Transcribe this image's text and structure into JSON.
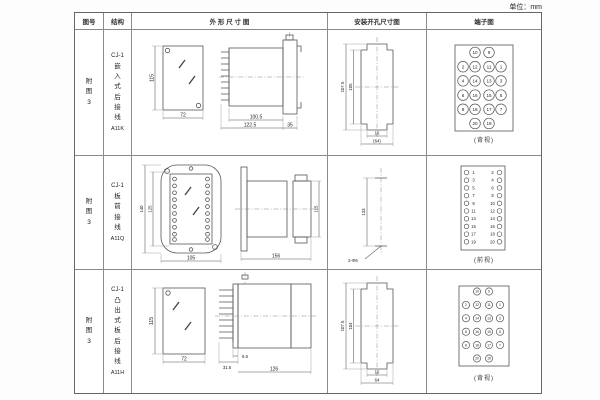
{
  "unit_label": "单位：mm",
  "headers": {
    "fig_no": "图号",
    "structure": "结构",
    "outline": "外 形 尺 寸 图",
    "install": "安装开孔尺寸图",
    "terminal": "端子图"
  },
  "rows": [
    {
      "fig_no": "附图3",
      "model": "CJ-1",
      "mount": "嵌入式后接线",
      "code": "A11K",
      "outline": {
        "front_h": "115",
        "front_w": "72",
        "body_d": "100.5",
        "total_d": "122.5",
        "flange_d": "35"
      },
      "install": {
        "outer_h": "107.5",
        "inner_h": "105",
        "slot_w": "16",
        "hole_w": "(64)"
      },
      "terminal": {
        "layout": "rear",
        "size": "lg",
        "caption": "(背视)",
        "side_left": [
          "2",
          "4",
          "6",
          "8"
        ],
        "mid_left": [
          "10",
          "12",
          "14",
          "16",
          "18",
          "20"
        ],
        "mid_right": [
          "9",
          "11",
          "13",
          "15",
          "17",
          "19"
        ],
        "side_right": [
          "1",
          "3",
          "5",
          "7"
        ]
      }
    },
    {
      "fig_no": "附图3",
      "model": "CJ-1",
      "mount": "板前接线",
      "code": "A11Q",
      "outline": {
        "front_outer_h": "140",
        "front_inner_h": "125",
        "front_w": "105",
        "total_d": "156",
        "body_h": "115"
      },
      "install": {
        "hole_pitch": "133",
        "hole_note": "2-Φ6"
      },
      "terminal": {
        "layout": "front",
        "caption": "(前视)",
        "pairs": [
          [
            "1",
            "2"
          ],
          [
            "3",
            "4"
          ],
          [
            "5",
            "6"
          ],
          [
            "7",
            "8"
          ],
          [
            "9",
            "10"
          ],
          [
            "11",
            "12"
          ],
          [
            "13",
            "14"
          ],
          [
            "15",
            "16"
          ],
          [
            "17",
            "18"
          ],
          [
            "19",
            "20"
          ]
        ]
      }
    },
    {
      "fig_no": "附图3",
      "model": "CJ-1",
      "mount": "凸出式板后接线",
      "code": "A11H",
      "outline": {
        "front_h": "115",
        "front_w": "72",
        "pin_d": "9.5",
        "base_d": "31.5",
        "body_d": "126"
      },
      "install": {
        "outer_h": "107.5",
        "inner_h": "104",
        "slot_w": "16",
        "hole_w": "64"
      },
      "terminal": {
        "layout": "rear",
        "size": "sm",
        "caption": "(背视)",
        "side_left": [
          "2",
          "4",
          "6",
          "8"
        ],
        "mid_left": [
          "10",
          "12",
          "14",
          "16",
          "18",
          "20"
        ],
        "mid_right": [
          "9",
          "11",
          "13",
          "15",
          "17",
          "19"
        ],
        "side_right": [
          "1",
          "3",
          "5",
          "7"
        ]
      }
    }
  ]
}
